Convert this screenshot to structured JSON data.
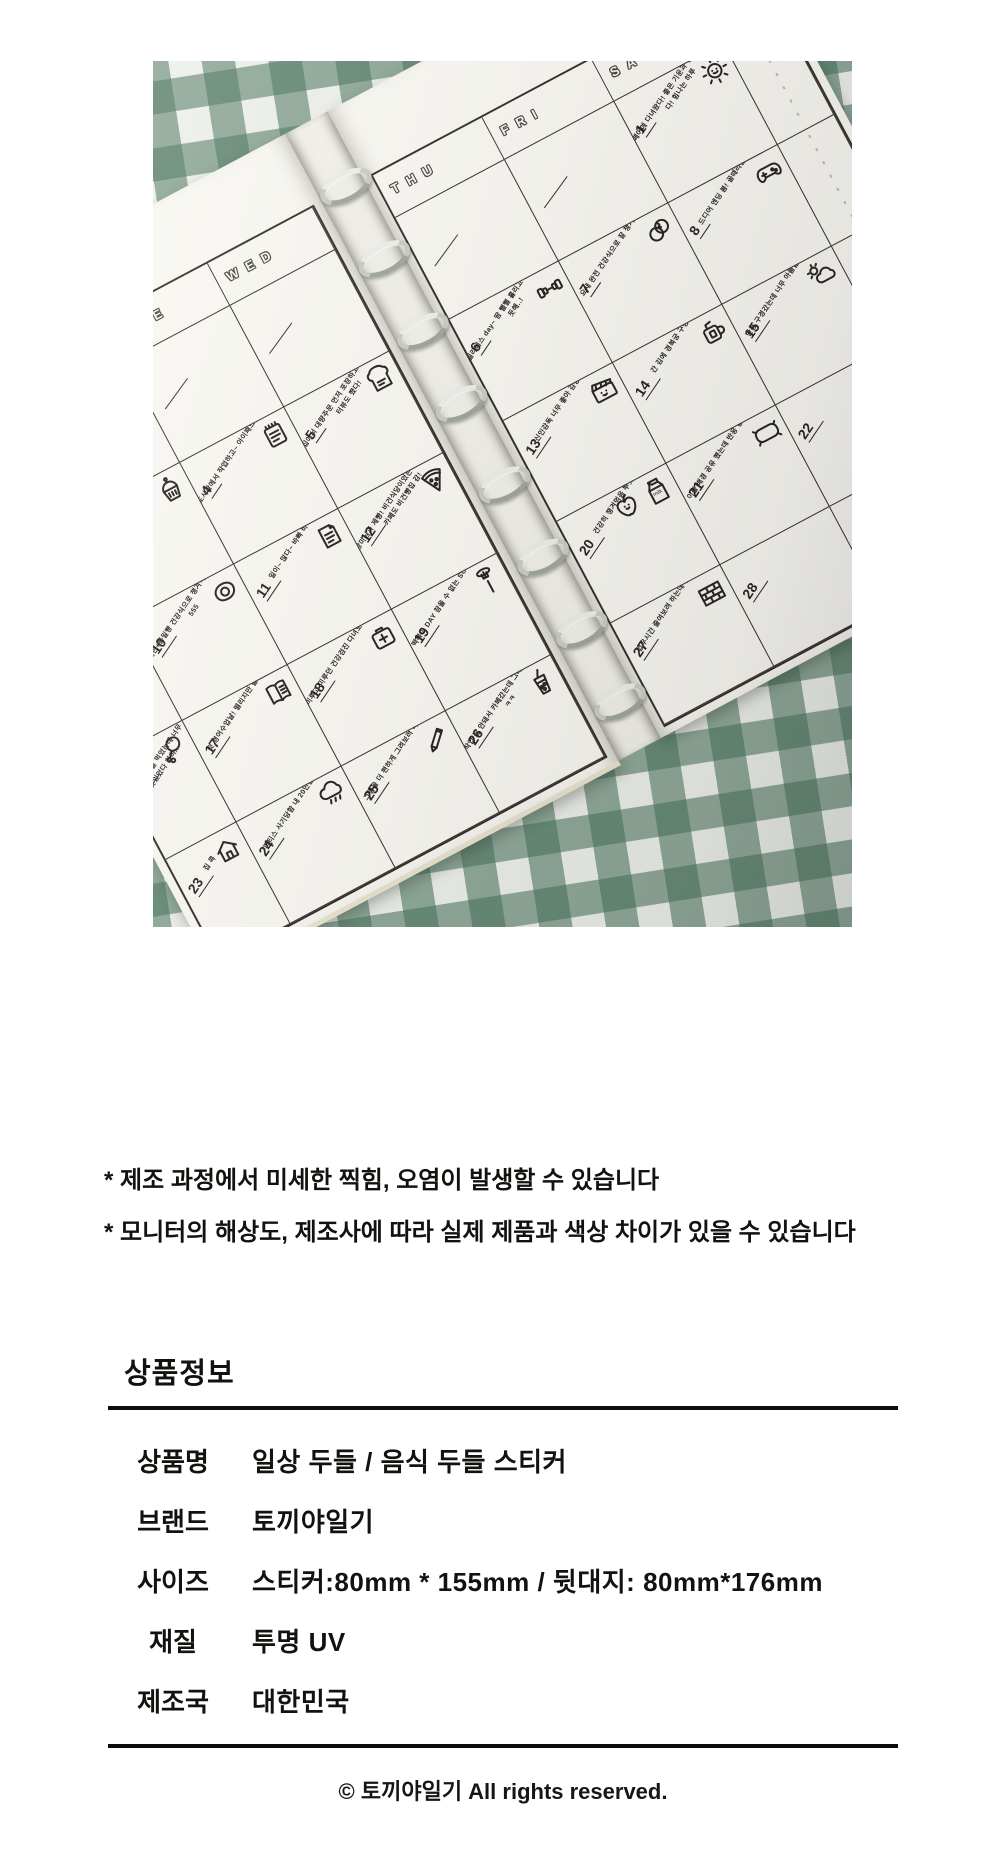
{
  "photo": {
    "description_colors": {
      "fabric_green": "#4d7a62",
      "fabric_light": "#edf0ea",
      "page": "#f9f8f3",
      "ink": "#2b2724"
    },
    "milk_label": "milk",
    "month_doodle": {
      "rows": [
        [
          {
            "t": "1"
          },
          {
            "t": "0"
          },
          {
            "t": "11",
            "filled": true
          },
          {
            "t": "2"
          },
          {
            "t": "3"
          }
        ],
        [
          {
            "t": "4"
          },
          {
            "t": "5"
          },
          {
            "t": "6"
          },
          {
            "t": "7"
          },
          {
            "t": "8"
          },
          {
            "t": "9"
          }
        ]
      ]
    },
    "left_page": {
      "headers": [
        "",
        "MON",
        "TUE",
        "WED"
      ],
      "rows": [
        [
          {},
          {},
          {},
          {}
        ],
        [
          {},
          {
            "n": "3",
            "icon": "cupcake",
            "note": "일이 잘 안되면 설탕을 섭취한다"
          },
          {
            "n": "4",
            "icon": "notepad",
            "note": "도서관에서 작업하고~ 아이패드를 구경했다"
          },
          {
            "n": "5",
            "icon": "toast",
            "note": "집에서 대량주문 먼저 포장하고 작업~ + 인터뷰도 했다!"
          }
        ],
        [
          {
            "n": "9",
            "icon": "washing-machine",
            "note": "주말이니까 대청소 DAY"
          },
          {
            "n": "10",
            "icon": "fried-egg",
            "note": "계란+통밀빵 건강식으로 챙겨먹어서 뿌듯! 555"
          },
          {
            "n": "11",
            "icon": "papers",
            "note": "일이~ 많다~ 바빠 바빠"
          },
          {
            "n": "12",
            "icon": "pizza",
            "note": "장미님과 제빵! 비건식당이었는데 맛있었어! 카페도 비건빵집 감!"
          }
        ],
        [
          {
            "n": "16",
            "icon": "chicken-leg",
            "note": "저녁으로 닭발 먹었는데 너무 맛있었다 히히.."
          },
          {
            "n": "17",
            "icon": "book",
            "note": "첫 영어수업날! 떨리지만 즐거웠어!"
          },
          {
            "n": "18",
            "icon": "health-sign",
            "note": "미루고 미루던 건강검진 다녀오기 건강하자"
          },
          {
            "n": "19",
            "icon": "fork-food",
            "note": "떡볶이 DAY 참을 수 없는 SOULFOOD"
          }
        ],
        [
          {
            "n": "23",
            "icon": "house",
            "note": "집 콕"
          },
          {
            "n": "24",
            "icon": "rain-cloud",
            "note": "피티스 사기당함 내 20만원 ㅠㅠ"
          },
          {
            "n": "25",
            "icon": "pencil",
            "note": "그림을 더 편하게 그려보려 하는 중 ..."
          },
          {
            "n": "26",
            "icon": "bubble-tea",
            "note": "작업 잘 안돼서 카페갔는데 그래도 잘 안됨 ㅋㅋ"
          }
        ]
      ]
    },
    "right_page": {
      "headers": [
        "THU",
        "FRI",
        "SAT"
      ],
      "rows": [
        [
          {},
          {},
          {
            "n": "1",
            "icon": "sun",
            "note": "페어에 다녀왔다! 좋은 기운과 정보를 얻어왔다! 힘나는 하루"
          }
        ],
        [
          {
            "n": "6",
            "icon": "dumbbell",
            "note": "필라테스 day~ 땀 뻘뻘 흘리고 힘들었지만 뿌듯해..!"
          },
          {
            "n": "7",
            "icon": "eggs",
            "note": "요새 완전 건강식으로 잘 챙겨먹음 뿌듯.."
          },
          {
            "n": "8",
            "icon": "game-controller",
            "note": "드디어 엔딩 봄! 골때리는 엔딩"
          }
        ],
        [
          {
            "n": "13",
            "icon": "clapperboard",
            "note": "신인감독 너무 좋아 감동 ㅠㅠ"
          },
          {
            "n": "14",
            "icon": "mug",
            "note": "간 김에 경복궁 구경~"
          },
          {
            "n": "15",
            "icon": "cloud-sun",
            "note": "단풍 구경갔는데 너무 아름답고 좋았다"
          }
        ],
        [
          {
            "n": "20",
            "icon": "apple milk-carton",
            "note": "건강히 챙겨먹음 뿌듯!!"
          },
          {
            "n": "21",
            "icon": "pillow",
            "note": "이불 배경 공유 했는데 반응 좋아서 뿌듯.."
          },
          {
            "n": "22",
            "icon": "tv",
            "note": ""
          }
        ],
        [
          {
            "n": "27",
            "icon": "brick-wall",
            "note": "업무시간 줄여보려 하는데 잘 안돼!!"
          },
          {
            "n": "28",
            "icon": "",
            "note": ""
          },
          {}
        ]
      ]
    }
  },
  "notes": {
    "line1": "* 제조 과정에서 미세한 찍힘, 오염이 발생할 수 있습니다",
    "line2": "* 모니터의 해상도, 제조사에 따라 실제 제품과 색상 차이가 있을 수 있습니다"
  },
  "product_info": {
    "heading": "상품정보",
    "rows": [
      {
        "label": "상품명",
        "value": "일상 두들 / 음식 두들 스티커"
      },
      {
        "label": "브랜드",
        "value": "토끼야일기"
      },
      {
        "label": "사이즈",
        "value": "스티커:80mm * 155mm / 뒷대지: 80mm*176mm"
      },
      {
        "label": "재질",
        "value": "투명 UV"
      },
      {
        "label": "제조국",
        "value": "대한민국"
      }
    ]
  },
  "footer": {
    "copyright": "© 토끼야일기 All rights reserved."
  }
}
